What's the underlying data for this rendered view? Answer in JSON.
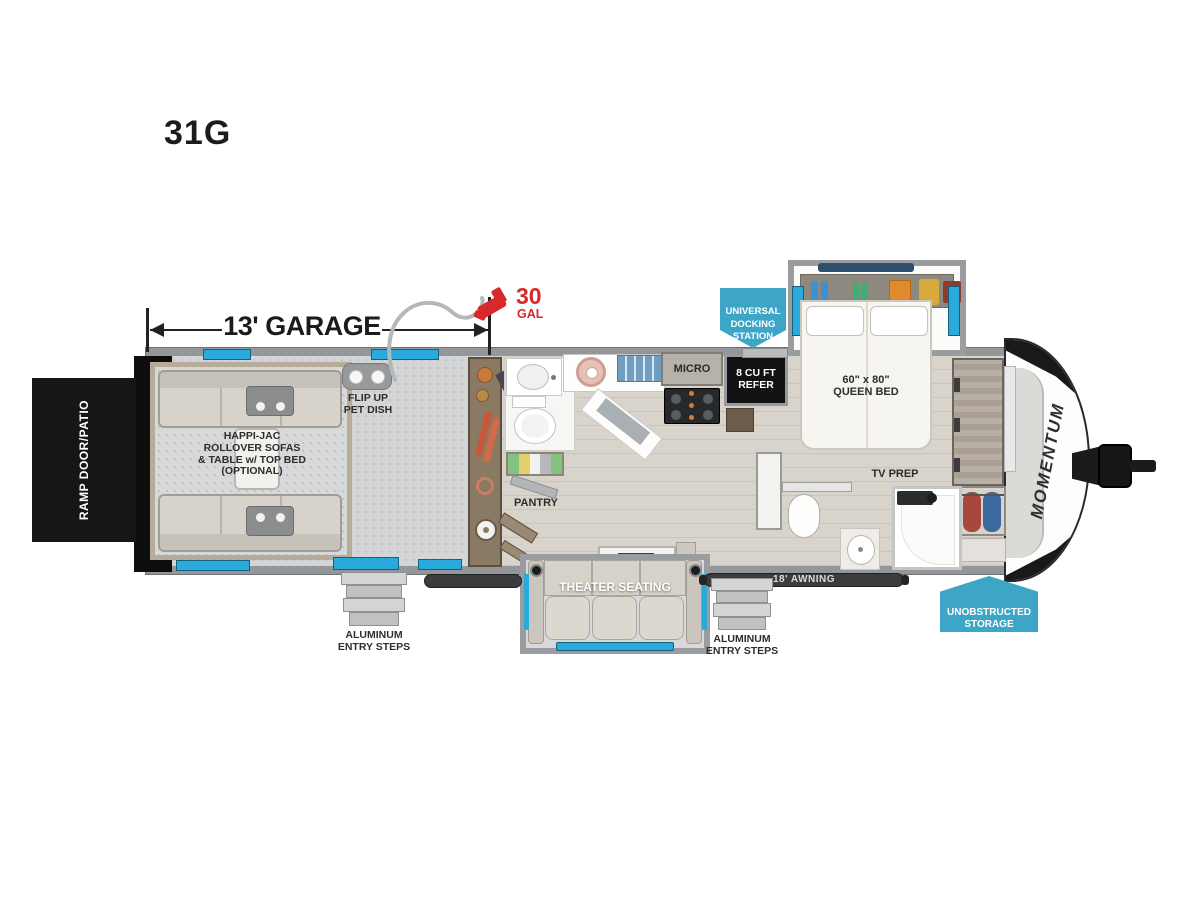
{
  "title": "31G",
  "dimension": {
    "label": "13' GARAGE"
  },
  "fuel": {
    "amount": "30",
    "unit": "GAL"
  },
  "badges": {
    "docking": "UNIVERSAL\nDOCKING\nSTATION",
    "storage": "UNOBSTRUCTED\nSTORAGE"
  },
  "labels": {
    "ramp_door": "RAMP DOOR/PATIO",
    "garage_sofas": "HAPPI-JAC\nROLLOVER SOFAS\n& TABLE w/ TOP BED\n(OPTIONAL)",
    "pet_dish": "FLIP UP\nPET DISH",
    "pantry": "PANTRY",
    "micro": "MICRO",
    "refrigerator": "8 CU FT\nREFER",
    "queen_bed": "60\" x 80\"\nQUEEN BED",
    "tv_prep": "TV PREP",
    "theater_seating": "THEATER SEATING",
    "awning": "18' AWNING",
    "entry_steps_left": "ALUMINUM\nENTRY STEPS",
    "entry_steps_right": "ALUMINUM\nENTRY STEPS",
    "brand_logo": "MOMENTUM"
  },
  "colors": {
    "accent_blue": "#2aa9dd",
    "badge_blue": "#3da5c6",
    "alert_red": "#d7282a",
    "wall_gray": "#94979a",
    "ramp_black": "#161616"
  }
}
